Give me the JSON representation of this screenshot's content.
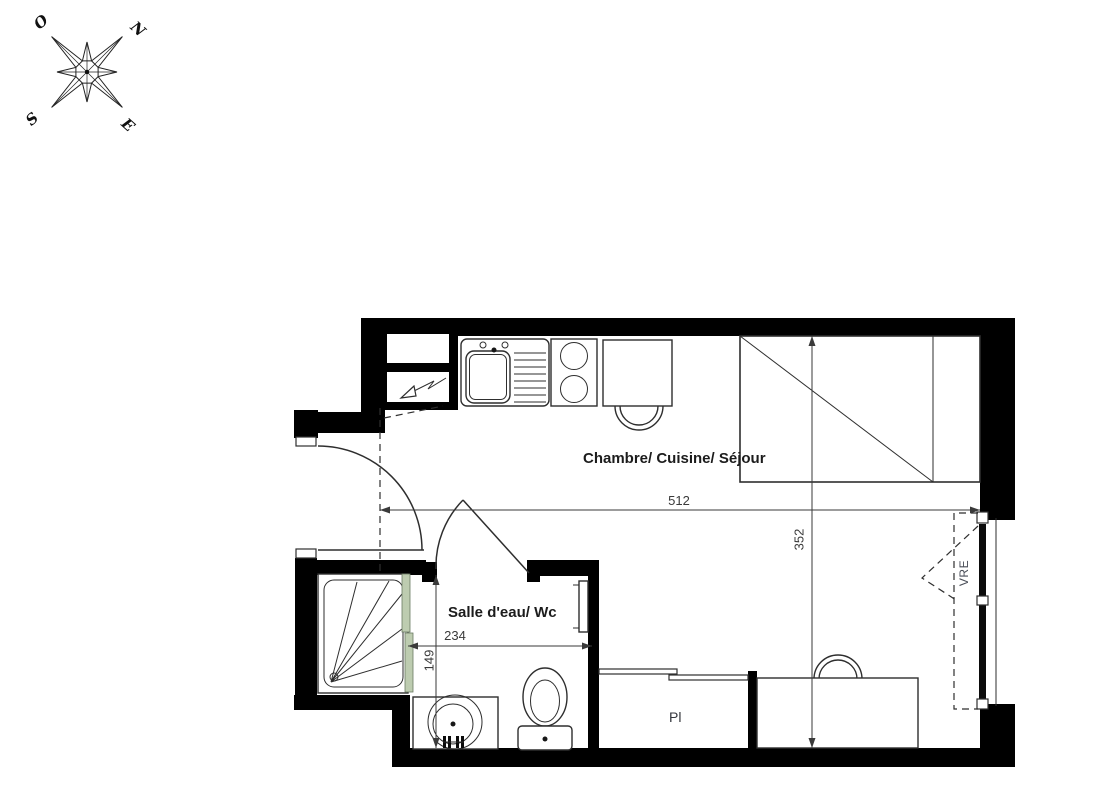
{
  "compass": {
    "west": "O",
    "north": "N",
    "south": "S",
    "east": "E"
  },
  "labels": {
    "main_room": "Chambre/ Cuisine/ Séjour",
    "bathroom": "Salle d'eau/ Wc",
    "closet": "Pl",
    "window_shutter": "VRE"
  },
  "dimensions": {
    "main_width": "512",
    "main_depth": "352",
    "bathroom_width": "234",
    "bathroom_depth": "149"
  },
  "colors": {
    "wall": "#000000",
    "line": "#2e2e2e",
    "dim": "#3a3a3a",
    "glass": "#bdccb0",
    "label": "#1c1c1c",
    "annot": "#4a4e58"
  }
}
